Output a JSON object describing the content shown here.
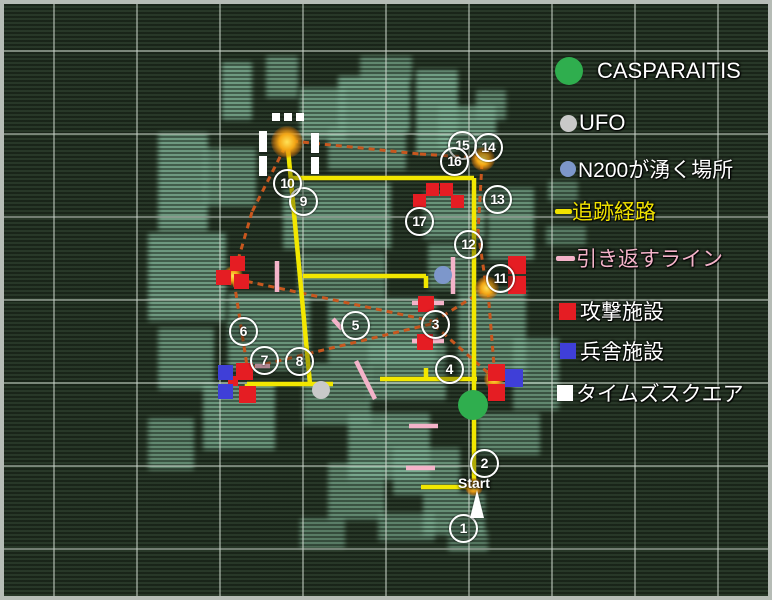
{
  "legend": {
    "items": [
      {
        "name": "casparaitis",
        "label": "CASPARAITIS",
        "marker": "circle",
        "color": "#2fae4e",
        "size": 28,
        "x": 555,
        "y": 57,
        "gap": 14,
        "text_color": "#ffffff",
        "font_size": 22
      },
      {
        "name": "ufo",
        "label": "UFO",
        "marker": "circle",
        "color": "#c9c9c9",
        "size": 17,
        "x": 560,
        "y": 110,
        "gap": 2,
        "text_color": "#ffffff",
        "font_size": 22
      },
      {
        "name": "n200-spawn",
        "label": "N200が湧く場所",
        "marker": "circle",
        "color": "#7d97cb",
        "size": 16,
        "x": 560,
        "y": 154,
        "gap": 2,
        "text_color": "#ffffff",
        "font_size": 21
      },
      {
        "name": "tracking-route",
        "label": "追跡経路",
        "marker": "dash",
        "color": "#f2e300",
        "size": 17,
        "x": 555,
        "y": 196,
        "gap": 0,
        "text_color": "#f2e300",
        "font_size": 21
      },
      {
        "name": "turnback-line",
        "label": "引き返すライン",
        "marker": "dash",
        "color": "#f4b3c9",
        "size": 19,
        "x": 556,
        "y": 243,
        "gap": 1,
        "text_color": "#f4b3c9",
        "font_size": 21
      },
      {
        "name": "attack-facility",
        "label": "攻撃施設",
        "marker": "square",
        "color": "#e51d23",
        "size": 17,
        "x": 559,
        "y": 296,
        "gap": 4,
        "text_color": "#ffffff",
        "font_size": 21
      },
      {
        "name": "barracks-facility",
        "label": "兵舎施設",
        "marker": "square",
        "color": "#3f3fd8",
        "size": 16,
        "x": 560,
        "y": 336,
        "gap": 4,
        "text_color": "#ffffff",
        "font_size": 21
      },
      {
        "name": "times-square",
        "label": "タイムズスクエア",
        "marker": "square",
        "color": "#ffffff",
        "size": 16,
        "x": 557,
        "y": 378,
        "gap": 3,
        "text_color": "#ffffff",
        "font_size": 21
      }
    ]
  },
  "map": {
    "start": {
      "label": "Start",
      "x": 458,
      "y": 475
    },
    "grid": {
      "x_lines": [
        53,
        136,
        219,
        302,
        385,
        468,
        551,
        634,
        717
      ],
      "y_lines": [
        50,
        133,
        216,
        299,
        382,
        465,
        548
      ]
    },
    "buildings": [
      [
        222,
        62,
        30,
        58,
        0.8
      ],
      [
        266,
        56,
        32,
        42,
        0.7
      ],
      [
        300,
        88,
        46,
        52,
        0.8
      ],
      [
        338,
        76,
        72,
        56,
        0.85
      ],
      [
        360,
        56,
        52,
        24,
        0.65
      ],
      [
        416,
        70,
        42,
        84,
        0.85
      ],
      [
        438,
        106,
        58,
        42,
        0.8
      ],
      [
        476,
        90,
        30,
        30,
        0.65
      ],
      [
        328,
        128,
        78,
        42,
        0.7
      ],
      [
        158,
        133,
        50,
        98,
        0.8
      ],
      [
        204,
        148,
        52,
        58,
        0.7
      ],
      [
        283,
        183,
        108,
        66,
        0.75
      ],
      [
        423,
        193,
        62,
        46,
        0.75
      ],
      [
        488,
        188,
        46,
        72,
        0.7
      ],
      [
        148,
        233,
        78,
        88,
        0.8
      ],
      [
        298,
        253,
        88,
        46,
        0.65
      ],
      [
        428,
        243,
        46,
        46,
        0.65
      ],
      [
        458,
        288,
        68,
        88,
        0.7
      ],
      [
        328,
        298,
        108,
        66,
        0.75
      ],
      [
        228,
        293,
        82,
        77,
        0.75
      ],
      [
        158,
        328,
        56,
        62,
        0.7
      ],
      [
        303,
        363,
        68,
        62,
        0.65
      ],
      [
        368,
        343,
        78,
        57,
        0.7
      ],
      [
        513,
        338,
        46,
        72,
        0.65
      ],
      [
        478,
        413,
        62,
        42,
        0.65
      ],
      [
        203,
        383,
        72,
        67,
        0.75
      ],
      [
        148,
        418,
        46,
        52,
        0.65
      ],
      [
        348,
        413,
        82,
        67,
        0.75
      ],
      [
        393,
        448,
        67,
        47,
        0.7
      ],
      [
        328,
        463,
        57,
        57,
        0.65
      ],
      [
        423,
        493,
        62,
        42,
        0.7
      ],
      [
        378,
        513,
        57,
        28,
        0.6
      ],
      [
        300,
        518,
        45,
        30,
        0.55
      ],
      [
        448,
        530,
        40,
        22,
        0.5
      ],
      [
        548,
        181,
        30,
        20,
        0.55
      ],
      [
        546,
        226,
        40,
        19,
        0.55
      ]
    ],
    "routes": {
      "tracking": {
        "color": "#f2e700",
        "width": 4.5,
        "segments": [
          [
            288,
            149,
            310,
            384
          ],
          [
            289,
            178,
            474,
            178
          ],
          [
            474,
            178,
            474,
            489
          ],
          [
            421,
            487,
            476,
            487
          ],
          [
            303,
            276,
            426,
            276
          ],
          [
            426,
            276,
            426,
            288
          ],
          [
            247,
            384,
            333,
            384
          ],
          [
            247,
            384,
            247,
            394
          ],
          [
            380,
            379,
            477,
            379
          ],
          [
            426,
            379,
            426,
            368
          ]
        ]
      },
      "chase": {
        "color": "#c8571e",
        "width": 3,
        "dash": "6 5",
        "segments": [
          [
            292,
            141,
            420,
            154
          ],
          [
            420,
            154,
            481,
            158
          ],
          [
            285,
            147,
            252,
            212
          ],
          [
            252,
            212,
            234,
            274
          ],
          [
            236,
            279,
            432,
            321
          ],
          [
            433,
            322,
            486,
            289
          ],
          [
            434,
            325,
            496,
            380
          ],
          [
            431,
            324,
            253,
            367
          ],
          [
            234,
            281,
            247,
            366
          ],
          [
            482,
            163,
            478,
            232
          ],
          [
            478,
            232,
            486,
            285
          ],
          [
            488,
            291,
            495,
            378
          ]
        ]
      },
      "turnback": {
        "color": "#f4b3c9",
        "width": 4.5,
        "segments": [
          [
            277,
            261,
            277,
            292
          ],
          [
            453,
            257,
            453,
            294
          ],
          [
            412,
            303,
            444,
            303
          ],
          [
            412,
            341,
            444,
            341
          ],
          [
            333,
            319,
            342,
            329
          ],
          [
            255,
            366,
            270,
            366
          ],
          [
            356,
            361,
            375,
            399
          ],
          [
            409,
            426,
            438,
            426
          ],
          [
            406,
            468,
            435,
            468
          ]
        ]
      }
    },
    "glows": [
      [
        287,
        142,
        16
      ],
      [
        483,
        159,
        12
      ],
      [
        487,
        288,
        12
      ],
      [
        233,
        276,
        10
      ],
      [
        494,
        379,
        10
      ],
      [
        474,
        487,
        9
      ]
    ],
    "attack_squares": [
      [
        230,
        256,
        15
      ],
      [
        216,
        270,
        15
      ],
      [
        234,
        274,
        15
      ],
      [
        413,
        194,
        13
      ],
      [
        426,
        183,
        13
      ],
      [
        440,
        183,
        13
      ],
      [
        451,
        195,
        13
      ],
      [
        418,
        296,
        16
      ],
      [
        417,
        334,
        16
      ],
      [
        508,
        256,
        18
      ],
      [
        508,
        276,
        18
      ],
      [
        488,
        364,
        17
      ],
      [
        488,
        384,
        17
      ],
      [
        236,
        363,
        17
      ],
      [
        239,
        386,
        17
      ],
      [
        228,
        376,
        10
      ]
    ],
    "barracks_squares": [
      [
        218,
        365,
        15
      ],
      [
        218,
        384,
        15
      ],
      [
        505,
        369,
        18
      ]
    ],
    "times_square_marks": [
      [
        272,
        113,
        8,
        8
      ],
      [
        284,
        113,
        8,
        8
      ],
      [
        296,
        113,
        8,
        8
      ],
      [
        259,
        131,
        8,
        21
      ],
      [
        259,
        156,
        8,
        20
      ],
      [
        311,
        133,
        8,
        20
      ],
      [
        311,
        157,
        8,
        17
      ]
    ],
    "poi": {
      "casparaitis": {
        "x": 473,
        "y": 405,
        "r": 15,
        "color": "#2fae4e"
      },
      "ufo": {
        "x": 321,
        "y": 390,
        "r": 9,
        "color": "#c9c9c9"
      },
      "n200": {
        "x": 443,
        "y": 275,
        "r": 9,
        "color": "#7d97cb"
      }
    },
    "markers": [
      {
        "n": "1",
        "x": 461,
        "y": 526
      },
      {
        "n": "2",
        "x": 482,
        "y": 461
      },
      {
        "n": "3",
        "x": 433,
        "y": 322
      },
      {
        "n": "4",
        "x": 447,
        "y": 367
      },
      {
        "n": "5",
        "x": 353,
        "y": 323
      },
      {
        "n": "6",
        "x": 241,
        "y": 329
      },
      {
        "n": "7",
        "x": 262,
        "y": 358
      },
      {
        "n": "8",
        "x": 297,
        "y": 359
      },
      {
        "n": "9",
        "x": 301,
        "y": 199
      },
      {
        "n": "10",
        "x": 285,
        "y": 181
      },
      {
        "n": "11",
        "x": 498,
        "y": 276
      },
      {
        "n": "12",
        "x": 466,
        "y": 242
      },
      {
        "n": "13",
        "x": 495,
        "y": 197
      },
      {
        "n": "14",
        "x": 486,
        "y": 145
      },
      {
        "n": "15",
        "x": 460,
        "y": 143
      },
      {
        "n": "16",
        "x": 452,
        "y": 159
      },
      {
        "n": "17",
        "x": 417,
        "y": 219
      }
    ]
  }
}
